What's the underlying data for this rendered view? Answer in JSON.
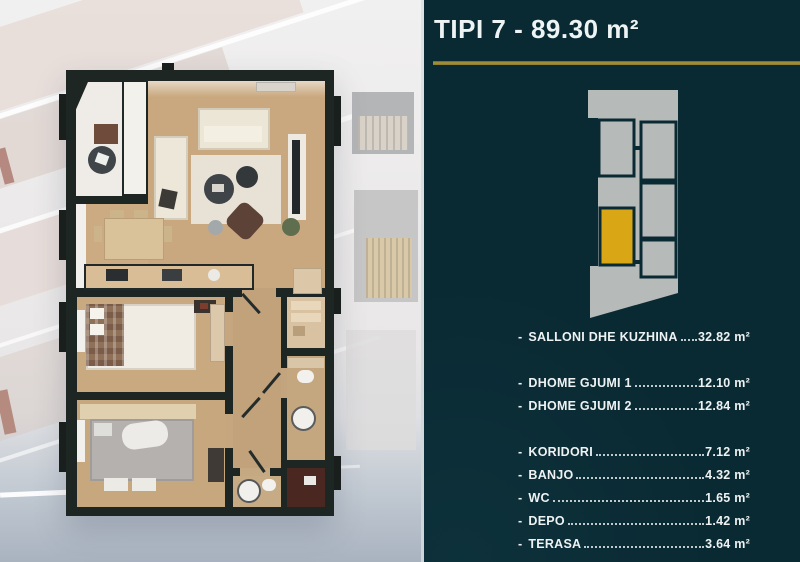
{
  "header": {
    "title": "TIPI 7 - 89.30 m²"
  },
  "panel": {
    "dash": "-",
    "rooms": [
      {
        "label": "SALLONI DHE KUZHINA",
        "area": "32.82 m²"
      },
      {
        "label": "DHOME GJUMI 1",
        "area": "12.10 m²"
      },
      {
        "label": "DHOME GJUMI 2",
        "area": "12.84 m²"
      },
      {
        "label": "KORIDORI",
        "area": "7.12 m²"
      },
      {
        "label": "BANJO",
        "area": "4.32 m²"
      },
      {
        "label": "WC",
        "area": "1.65 m²"
      },
      {
        "label": "DEPO",
        "area": "1.42 m²"
      },
      {
        "label": "TERASA",
        "area": "3.64 m²"
      }
    ]
  },
  "colors": {
    "panel_background": "#0a2a33",
    "accent_gold": "#a89440",
    "title_text": "#eef4f4",
    "diagram_footprint_gray": "#b6bab9",
    "diagram_unit_highlight": "#d9a715",
    "plan_wall": "#1e2624",
    "plan_wood_floor": "#c9a87f"
  }
}
